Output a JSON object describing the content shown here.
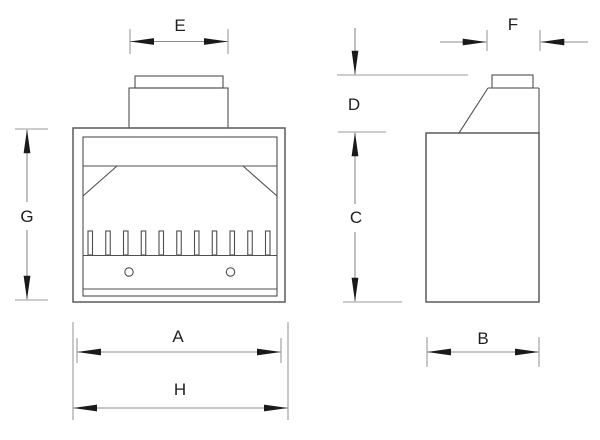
{
  "drawing": {
    "type": "technical-dimension-drawing",
    "background_color": "#ffffff",
    "colors": {
      "outline": "#5a5a5a",
      "inner_detail": "#4f4f4f",
      "dimension_line": "#8c8c8c",
      "arrowhead": "#1a1a1a",
      "label": "#1f1f1f"
    },
    "views": {
      "front": {
        "name": "front-view",
        "grate_bar_count": 11,
        "air_hole_count": 2,
        "dimensions": [
          {
            "id": "flue-width",
            "label": "E"
          },
          {
            "id": "overall-height",
            "label": "G"
          },
          {
            "id": "inner-width",
            "label": "A"
          },
          {
            "id": "overall-width",
            "label": "H"
          }
        ]
      },
      "side": {
        "name": "side-view",
        "dimensions": [
          {
            "id": "flue-depth",
            "label": "F"
          },
          {
            "id": "chimney-height",
            "label": "D"
          },
          {
            "id": "body-height",
            "label": "C"
          },
          {
            "id": "overall-depth",
            "label": "B"
          }
        ]
      }
    }
  }
}
